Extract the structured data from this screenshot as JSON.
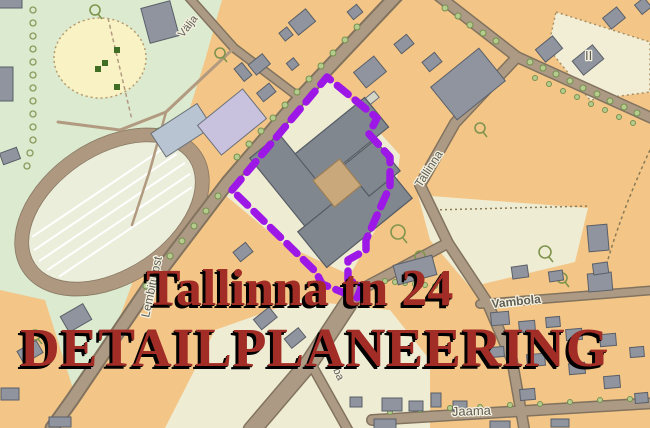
{
  "map": {
    "title_overlay": {
      "line1": "Tallinna tn 24",
      "line2": "DETAILPLANEERING",
      "text_color": "#a12d26",
      "shadow_color": "#000000"
    },
    "street_labels": {
      "valja": "Välja",
      "tallinna": "Tallinna",
      "lembitu": "Lembitu pst",
      "vambola": "Vambola",
      "jaama": "Jaama",
      "kauba": "Kauba"
    },
    "area_labels": {
      "stand_number": "II"
    },
    "legend_colors": {
      "plan_boundary": "#9d18e6",
      "residential_parcel": "#f3c687",
      "park_green": "#dcead0",
      "parcel_cream": "#efecd4",
      "meadow_yellow": "#f8f2c5",
      "building_gray": "#8f949e",
      "road_brown": "#ac9a85"
    }
  }
}
